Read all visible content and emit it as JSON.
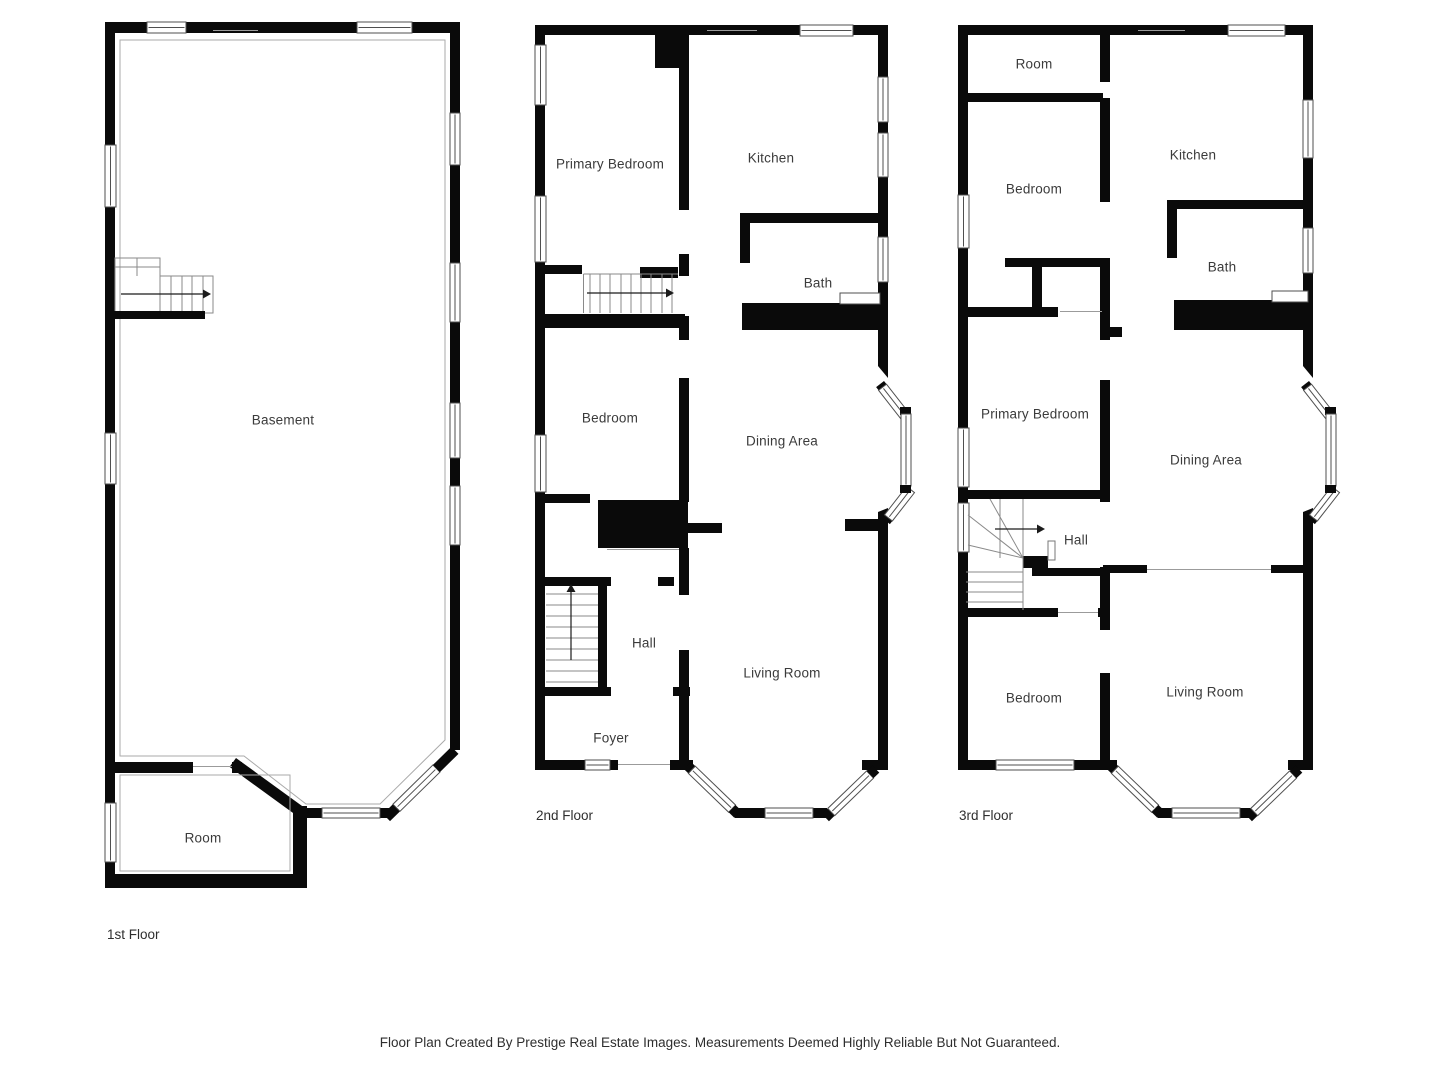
{
  "floors": [
    {
      "label": "1st Floor",
      "rooms": [
        "Basement",
        "Room"
      ]
    },
    {
      "label": "2nd Floor",
      "rooms": [
        "Primary Bedroom",
        "Kitchen",
        "Bath",
        "Bedroom",
        "Dining Area",
        "Hall",
        "Foyer",
        "Living Room"
      ]
    },
    {
      "label": "3rd Floor",
      "rooms": [
        "Room",
        "Bedroom",
        "Kitchen",
        "Bath",
        "Primary Bedroom",
        "Dining Area",
        "Hall",
        "Bedroom",
        "Living Room"
      ]
    }
  ],
  "footer": "Floor Plan Created By Prestige Real Estate Images. Measurements Deemed Highly Reliable But Not Guaranteed.",
  "colors": {
    "wall": "#0a0a0a",
    "background": "#ffffff",
    "label_text": "#3b3b3b"
  }
}
